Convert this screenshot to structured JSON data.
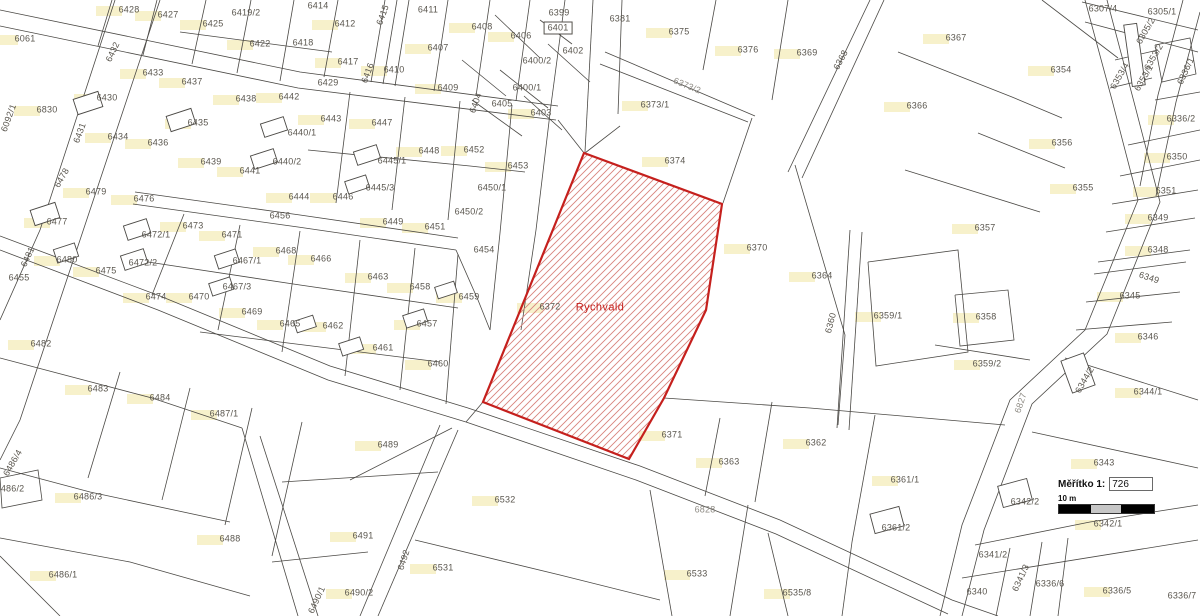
{
  "map": {
    "highlight": {
      "parcel": "6372",
      "area_name": "Rychvald"
    },
    "colors": {
      "highlight_outline": "#c5201d",
      "hatch_line": "#d8837c",
      "map_line": "#4b4945",
      "label_text": "#5a564e",
      "building_patch": "#f6efc5"
    },
    "labels": [
      {
        "t": "6061",
        "x": 25,
        "y": 39,
        "p": 1
      },
      {
        "t": "6830",
        "x": 47,
        "y": 110,
        "p": 1
      },
      {
        "t": "6092/1",
        "x": 9,
        "y": 118,
        "r": -70
      },
      {
        "t": "6428",
        "x": 129,
        "y": 10,
        "p": 1
      },
      {
        "t": "6427",
        "x": 168,
        "y": 15,
        "p": 1
      },
      {
        "t": "6425",
        "x": 213,
        "y": 24,
        "p": 1
      },
      {
        "t": "6419/2",
        "x": 246,
        "y": 13
      },
      {
        "t": "6422",
        "x": 260,
        "y": 44,
        "p": 1
      },
      {
        "t": "6432",
        "x": 113,
        "y": 52,
        "r": -65
      },
      {
        "t": "6433",
        "x": 153,
        "y": 73,
        "p": 1
      },
      {
        "t": "6437",
        "x": 192,
        "y": 82,
        "p": 1
      },
      {
        "t": "6430",
        "x": 107,
        "y": 98,
        "p": 1
      },
      {
        "t": "6431",
        "x": 80,
        "y": 133,
        "r": -70
      },
      {
        "t": "6434",
        "x": 118,
        "y": 137,
        "p": 1
      },
      {
        "t": "6436",
        "x": 158,
        "y": 143,
        "p": 1
      },
      {
        "t": "6435",
        "x": 198,
        "y": 123,
        "p": 1
      },
      {
        "t": "6438",
        "x": 246,
        "y": 99,
        "p": 1
      },
      {
        "t": "6442",
        "x": 289,
        "y": 97,
        "p": 1
      },
      {
        "t": "6439",
        "x": 211,
        "y": 162,
        "p": 1
      },
      {
        "t": "6441",
        "x": 250,
        "y": 171,
        "p": 1
      },
      {
        "t": "6440/1",
        "x": 302,
        "y": 133
      },
      {
        "t": "6440/2",
        "x": 287,
        "y": 162
      },
      {
        "t": "6443",
        "x": 331,
        "y": 119,
        "p": 1
      },
      {
        "t": "6444",
        "x": 299,
        "y": 197,
        "p": 1
      },
      {
        "t": "6446",
        "x": 343,
        "y": 197,
        "p": 1
      },
      {
        "t": "6445/1",
        "x": 392,
        "y": 161
      },
      {
        "t": "6445/3",
        "x": 380,
        "y": 188
      },
      {
        "t": "6447",
        "x": 382,
        "y": 123,
        "p": 1
      },
      {
        "t": "6448",
        "x": 429,
        "y": 151,
        "p": 1
      },
      {
        "t": "6449",
        "x": 393,
        "y": 222,
        "p": 1
      },
      {
        "t": "6451",
        "x": 435,
        "y": 227,
        "p": 1
      },
      {
        "t": "6418",
        "x": 303,
        "y": 43
      },
      {
        "t": "6414",
        "x": 318,
        "y": 6
      },
      {
        "t": "6412",
        "x": 345,
        "y": 24,
        "p": 1
      },
      {
        "t": "6415",
        "x": 383,
        "y": 15,
        "r": -70
      },
      {
        "t": "6411",
        "x": 428,
        "y": 10
      },
      {
        "t": "6417",
        "x": 348,
        "y": 62,
        "p": 1
      },
      {
        "t": "6416",
        "x": 368,
        "y": 73,
        "r": -70
      },
      {
        "t": "6410",
        "x": 394,
        "y": 70,
        "p": 1
      },
      {
        "t": "6429",
        "x": 328,
        "y": 83
      },
      {
        "t": "6409",
        "x": 448,
        "y": 88,
        "p": 1
      },
      {
        "t": "6407",
        "x": 438,
        "y": 48,
        "p": 1
      },
      {
        "t": "6408",
        "x": 482,
        "y": 27,
        "p": 1
      },
      {
        "t": "6406",
        "x": 521,
        "y": 36,
        "p": 1
      },
      {
        "t": "6399",
        "x": 559,
        "y": 13
      },
      {
        "t": "6401",
        "x": 558,
        "y": 28,
        "s": "boxed"
      },
      {
        "t": "6402",
        "x": 573,
        "y": 51
      },
      {
        "t": "6400/2",
        "x": 537,
        "y": 61
      },
      {
        "t": "6400/1",
        "x": 527,
        "y": 88
      },
      {
        "t": "6403",
        "x": 541,
        "y": 113,
        "p": 1
      },
      {
        "t": "6404",
        "x": 476,
        "y": 103,
        "r": -70
      },
      {
        "t": "6405",
        "x": 502,
        "y": 104
      },
      {
        "t": "6456",
        "x": 280,
        "y": 216
      },
      {
        "t": "6452",
        "x": 474,
        "y": 150,
        "p": 1
      },
      {
        "t": "6453",
        "x": 518,
        "y": 166,
        "p": 1
      },
      {
        "t": "6450/1",
        "x": 492,
        "y": 188
      },
      {
        "t": "6450/2",
        "x": 469,
        "y": 212
      },
      {
        "t": "6454",
        "x": 484,
        "y": 250
      },
      {
        "t": "6381",
        "x": 620,
        "y": 19
      },
      {
        "t": "6375",
        "x": 679,
        "y": 32,
        "p": 1
      },
      {
        "t": "6376",
        "x": 748,
        "y": 50,
        "p": 1
      },
      {
        "t": "6369",
        "x": 807,
        "y": 53,
        "p": 1
      },
      {
        "t": "6368",
        "x": 841,
        "y": 60,
        "r": -62
      },
      {
        "t": "6373/2",
        "x": 687,
        "y": 86,
        "r": 22,
        "s": "road"
      },
      {
        "t": "6373/1",
        "x": 655,
        "y": 105,
        "p": 1
      },
      {
        "t": "6374",
        "x": 675,
        "y": 161,
        "p": 1
      },
      {
        "t": "6367",
        "x": 956,
        "y": 38,
        "p": 1
      },
      {
        "t": "6366",
        "x": 917,
        "y": 106,
        "p": 1
      },
      {
        "t": "6354",
        "x": 1061,
        "y": 70,
        "p": 1
      },
      {
        "t": "6356",
        "x": 1062,
        "y": 143,
        "p": 1
      },
      {
        "t": "6307/4",
        "x": 1103,
        "y": 9
      },
      {
        "t": "6305/1",
        "x": 1162,
        "y": 12
      },
      {
        "t": "6305/2",
        "x": 1146,
        "y": 31,
        "r": -60
      },
      {
        "t": "6353/2",
        "x": 1154,
        "y": 57,
        "r": -60
      },
      {
        "t": "6353/4",
        "x": 1120,
        "y": 76,
        "r": -60
      },
      {
        "t": "6353/1",
        "x": 1144,
        "y": 78,
        "r": -60
      },
      {
        "t": "6336/1",
        "x": 1186,
        "y": 71,
        "r": -65
      },
      {
        "t": "6336/2",
        "x": 1181,
        "y": 119,
        "p": 1
      },
      {
        "t": "6350",
        "x": 1177,
        "y": 157,
        "p": 1
      },
      {
        "t": "6351",
        "x": 1166,
        "y": 191,
        "p": 1
      },
      {
        "t": "6349",
        "x": 1158,
        "y": 218,
        "p": 1
      },
      {
        "t": "6348",
        "x": 1158,
        "y": 250,
        "p": 1
      },
      {
        "t": "6349",
        "x": 1149,
        "y": 278,
        "r": 18
      },
      {
        "t": "6345",
        "x": 1130,
        "y": 296,
        "p": 1
      },
      {
        "t": "6346",
        "x": 1148,
        "y": 337,
        "p": 1
      },
      {
        "t": "6355",
        "x": 1083,
        "y": 188,
        "p": 1
      },
      {
        "t": "6370",
        "x": 757,
        "y": 248,
        "p": 1
      },
      {
        "t": "6364",
        "x": 822,
        "y": 276,
        "p": 1
      },
      {
        "t": "6360",
        "x": 831,
        "y": 323,
        "r": -75
      },
      {
        "t": "6359/1",
        "x": 888,
        "y": 316,
        "p": 1
      },
      {
        "t": "6357",
        "x": 985,
        "y": 228,
        "p": 1
      },
      {
        "t": "6358",
        "x": 986,
        "y": 317,
        "p": 1
      },
      {
        "t": "6359/2",
        "x": 987,
        "y": 364,
        "p": 1
      },
      {
        "t": "6372",
        "x": 550,
        "y": 307,
        "p": 1
      },
      {
        "t": "Rychvald",
        "x": 600,
        "y": 308,
        "s": "red"
      },
      {
        "t": "6478",
        "x": 62,
        "y": 178,
        "r": -60
      },
      {
        "t": "6479",
        "x": 96,
        "y": 192,
        "p": 1
      },
      {
        "t": "6476",
        "x": 144,
        "y": 199,
        "p": 1
      },
      {
        "t": "6477",
        "x": 57,
        "y": 222,
        "p": 1
      },
      {
        "t": "6473",
        "x": 193,
        "y": 226,
        "p": 1
      },
      {
        "t": "6471",
        "x": 232,
        "y": 235,
        "p": 1
      },
      {
        "t": "6472/1",
        "x": 156,
        "y": 235
      },
      {
        "t": "6481",
        "x": 28,
        "y": 257,
        "r": -65
      },
      {
        "t": "6480",
        "x": 67,
        "y": 260,
        "p": 1
      },
      {
        "t": "6475",
        "x": 106,
        "y": 271,
        "p": 1
      },
      {
        "t": "6472/2",
        "x": 143,
        "y": 263
      },
      {
        "t": "6467/1",
        "x": 247,
        "y": 261
      },
      {
        "t": "6468",
        "x": 286,
        "y": 251,
        "p": 1
      },
      {
        "t": "6455",
        "x": 19,
        "y": 278
      },
      {
        "t": "6474",
        "x": 156,
        "y": 297,
        "p": 1
      },
      {
        "t": "6470",
        "x": 199,
        "y": 297,
        "p": 1
      },
      {
        "t": "6467/3",
        "x": 237,
        "y": 287
      },
      {
        "t": "6469",
        "x": 252,
        "y": 312,
        "p": 1
      },
      {
        "t": "6465",
        "x": 290,
        "y": 324,
        "p": 1
      },
      {
        "t": "6466",
        "x": 321,
        "y": 259,
        "p": 1
      },
      {
        "t": "6463",
        "x": 378,
        "y": 277,
        "p": 1
      },
      {
        "t": "6458",
        "x": 420,
        "y": 287,
        "p": 1
      },
      {
        "t": "6459",
        "x": 469,
        "y": 297,
        "p": 1
      },
      {
        "t": "6457",
        "x": 427,
        "y": 324,
        "p": 1
      },
      {
        "t": "6462",
        "x": 333,
        "y": 326,
        "p": 1
      },
      {
        "t": "6461",
        "x": 383,
        "y": 348,
        "p": 1
      },
      {
        "t": "6460",
        "x": 438,
        "y": 364,
        "p": 1
      },
      {
        "t": "6482",
        "x": 41,
        "y": 344,
        "p": 1
      },
      {
        "t": "6483",
        "x": 98,
        "y": 389,
        "p": 1
      },
      {
        "t": "6484",
        "x": 160,
        "y": 398,
        "p": 1
      },
      {
        "t": "6487/1",
        "x": 224,
        "y": 414,
        "p": 1
      },
      {
        "t": "6486/4",
        "x": 13,
        "y": 463,
        "r": -60
      },
      {
        "t": "6486/2",
        "x": 10,
        "y": 489
      },
      {
        "t": "6486/3",
        "x": 88,
        "y": 497,
        "p": 1
      },
      {
        "t": "6488",
        "x": 230,
        "y": 539,
        "p": 1
      },
      {
        "t": "6486/1",
        "x": 63,
        "y": 575,
        "p": 1
      },
      {
        "t": "6489",
        "x": 388,
        "y": 445,
        "p": 1
      },
      {
        "t": "6491",
        "x": 363,
        "y": 536,
        "p": 1
      },
      {
        "t": "6492",
        "x": 404,
        "y": 560,
        "r": -72
      },
      {
        "t": "6490/2",
        "x": 359,
        "y": 593,
        "p": 1
      },
      {
        "t": "6490/1",
        "x": 317,
        "y": 600,
        "r": -65
      },
      {
        "t": "6531",
        "x": 443,
        "y": 568,
        "p": 1
      },
      {
        "t": "6532",
        "x": 505,
        "y": 500,
        "p": 1
      },
      {
        "t": "6533",
        "x": 697,
        "y": 574,
        "p": 1
      },
      {
        "t": "6535/8",
        "x": 797,
        "y": 593,
        "p": 1
      },
      {
        "t": "6371",
        "x": 672,
        "y": 435,
        "p": 1
      },
      {
        "t": "6362",
        "x": 816,
        "y": 443,
        "p": 1
      },
      {
        "t": "6363",
        "x": 729,
        "y": 462,
        "p": 1
      },
      {
        "t": "6361/1",
        "x": 905,
        "y": 480,
        "p": 1
      },
      {
        "t": "6828",
        "x": 705,
        "y": 510,
        "s": "road"
      },
      {
        "t": "6361/2",
        "x": 896,
        "y": 528
      },
      {
        "t": "6343",
        "x": 1104,
        "y": 463,
        "p": 1
      },
      {
        "t": "6344/1",
        "x": 1148,
        "y": 392,
        "p": 1
      },
      {
        "t": "6344/2",
        "x": 1085,
        "y": 380,
        "r": -60
      },
      {
        "t": "6827",
        "x": 1021,
        "y": 403,
        "r": -72,
        "s": "road"
      },
      {
        "t": "6342/2",
        "x": 1025,
        "y": 502
      },
      {
        "t": "6342/1",
        "x": 1108,
        "y": 524,
        "p": 1
      },
      {
        "t": "6341/2",
        "x": 993,
        "y": 555
      },
      {
        "t": "6341/3",
        "x": 1021,
        "y": 578,
        "r": -65
      },
      {
        "t": "6340",
        "x": 977,
        "y": 592
      },
      {
        "t": "6336/6",
        "x": 1050,
        "y": 584
      },
      {
        "t": "6336/5",
        "x": 1117,
        "y": 591,
        "p": 1
      },
      {
        "t": "6336/7",
        "x": 1182,
        "y": 596
      }
    ]
  },
  "scale_widget": {
    "label": "Měřítko 1:",
    "value": "726",
    "bar_label": "10 m"
  }
}
